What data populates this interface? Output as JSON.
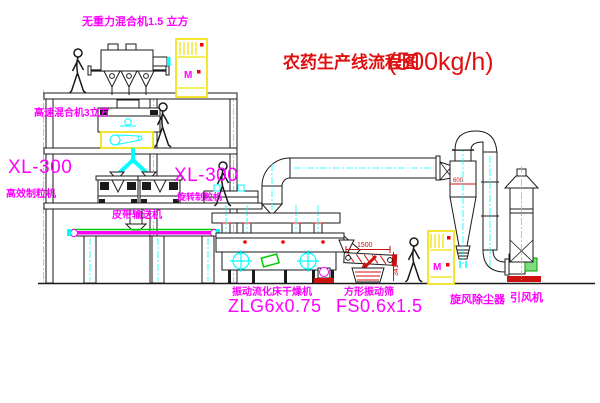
{
  "title": {
    "name": "农药生产线流程图",
    "capacity": "(500kg/h)"
  },
  "equipment_labels": {
    "gravity_mixer": "无重力混合机1.5 立方",
    "high_speed_mixer": "高速混合机3立方",
    "granulator_left_model": "XL-300",
    "granulator_left_name": "高效制粒机",
    "granulator_right_model": "XL-300",
    "granulator_right_name": "旋转制粒机",
    "belt_conveyor": "皮带输送机",
    "fluid_bed_dryer_name": "振动流化床干燥机",
    "fluid_bed_dryer_model": "ZLG6x0.75",
    "vibrating_screen_name": "方形振动筛",
    "vibrating_screen_model": "FS0.6x1.5",
    "cyclone_dust_collector": "旋风除尘器",
    "induced_draft_fan": "引风机"
  },
  "dimensions": {
    "screen_length": "1500",
    "screen_height": "341",
    "cyclone_mark": "600"
  },
  "symbols": {
    "motor": "M"
  },
  "colors": {
    "label_magenta": "#ff00ff",
    "title_red": "#e01010",
    "dim_red": "#cc1111",
    "line_cyan": "#00ffff",
    "cabinet_yellow": "#f0e000",
    "belt_green": "#00cc00",
    "line_black": "#1a1a1a"
  }
}
